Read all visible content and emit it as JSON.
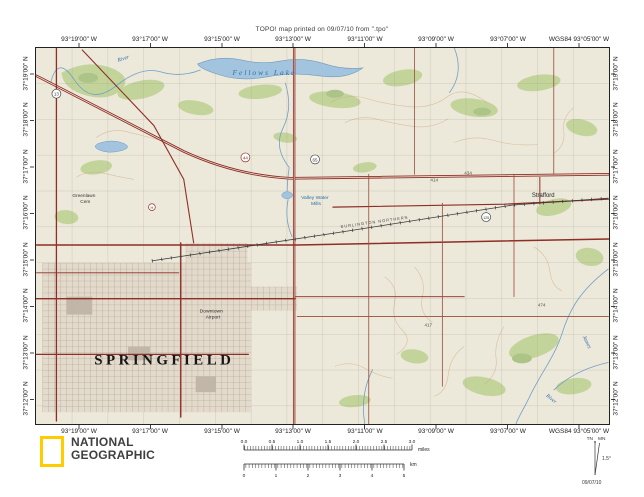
{
  "header": {
    "print_line": "TOPO! map printed on 09/07/10 from \".tpo\""
  },
  "coords": {
    "lon": [
      "93°19'00\" W",
      "93°17'00\" W",
      "93°15'00\" W",
      "93°13'00\" W",
      "93°11'00\" W",
      "93°09'00\" W",
      "93°07'00\" W",
      "WGS84 93°05'00\" W"
    ],
    "lat": [
      "37°19'00\" N",
      "37°18'00\" N",
      "37°17'00\" N",
      "37°16'00\" N",
      "37°15'00\" N",
      "37°14'00\" N",
      "37°13'00\" N",
      "37°12'00\" N"
    ]
  },
  "map_labels": {
    "city": "SPRINGFIELD",
    "lake": "Fellows Lake",
    "river_top": "River",
    "vwm1": "Valley Water",
    "vwm2": "Mills",
    "cem1": "Greenlawn",
    "cem2": "Cem",
    "strafford": "Strafford",
    "airport1": "Downtown",
    "airport2": "Airport",
    "james": "James",
    "river_br": "River",
    "railroad": "BURLINGTON NORTHERN",
    "elev1": "414",
    "elev2": "434",
    "elev3": "417",
    "elev4": "474",
    "shield_13": "13",
    "shield_44": "44",
    "shield_65": "65",
    "shield_125": "125",
    "hospital": "H"
  },
  "scalebar": {
    "miles": {
      "labels": [
        "0.0",
        "0.5",
        "1.0",
        "1.5",
        "2.0",
        "2.5",
        "3.0"
      ],
      "unit": "miles"
    },
    "km": {
      "labels": [
        "0",
        "1",
        "2",
        "3",
        "4",
        "5"
      ],
      "unit": "km"
    }
  },
  "declination": {
    "tn": "TN",
    "mn": "MN",
    "angle": "1.5°",
    "date": "09/07/10"
  },
  "logo": {
    "line1": "NATIONAL",
    "line2": "GEOGRAPHIC"
  }
}
